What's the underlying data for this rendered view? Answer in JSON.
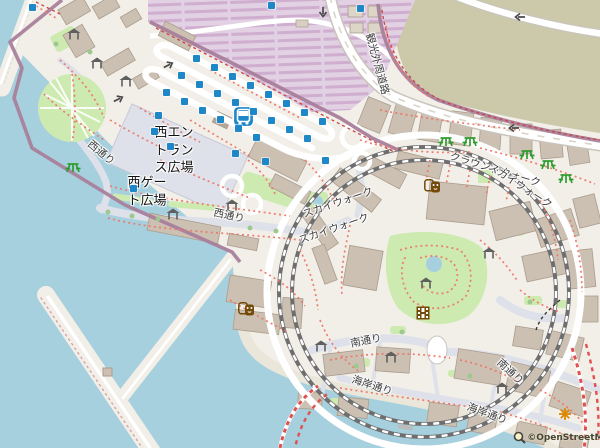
{
  "map": {
    "attribution": "©OpenStreetMap",
    "colors": {
      "water": "#a6d0dd",
      "land": "#f2efe9",
      "building": "#cbc0b2",
      "building_stroke": "#ab9d8d",
      "pedestrian": "#dee0ea",
      "grass": "#cdeab0",
      "heath": "#cbc9a9",
      "parking_stripe_dark": "#cfaed0",
      "parking_stripe_light": "#e2d0e3",
      "theme_park_boundary": "#a97f9b",
      "footpath": "#ee7768",
      "railway": "#6e6e6e",
      "bus_blue": "#1e87c8",
      "picnic_green": "#2e9b2e",
      "shelter_gray": "#5f5f5f",
      "amenity_brown": "#734a08",
      "attraction_orange": "#dd8800"
    },
    "labels": [
      {
        "id": "west-entrance-plaza",
        "text": "西エン\nトラン\nス広場",
        "x": 174,
        "y": 151,
        "rot": 0,
        "cls": "place"
      },
      {
        "id": "west-gate-plaza",
        "text": "西ゲー\nト広場",
        "x": 147,
        "y": 192,
        "rot": 0,
        "cls": "place"
      },
      {
        "id": "west-street-1",
        "text": "西通り",
        "x": 101,
        "y": 153,
        "rot": 40,
        "cls": "street"
      },
      {
        "id": "west-street-2",
        "text": "西通り",
        "x": 229,
        "y": 216,
        "rot": 12,
        "cls": "street"
      },
      {
        "id": "kanko-gaishu-road",
        "text": "観光外周道路",
        "x": 377,
        "y": 64,
        "rot": 75,
        "cls": "street"
      },
      {
        "id": "ground-walk",
        "text": "クラウンドウォーク",
        "x": 495,
        "y": 170,
        "rot": 17,
        "cls": "street"
      },
      {
        "id": "sky-walk-left-1",
        "text": "スカイウォーク",
        "x": 338,
        "y": 203,
        "rot": -19,
        "cls": "street"
      },
      {
        "id": "sky-walk-left-2",
        "text": "スカイウォーク",
        "x": 334,
        "y": 229,
        "rot": -19,
        "cls": "street"
      },
      {
        "id": "sky-walk-right",
        "text": "スカイウォーク",
        "x": 520,
        "y": 186,
        "rot": 33,
        "cls": "street"
      },
      {
        "id": "south-street-1",
        "text": "南通り",
        "x": 366,
        "y": 341,
        "rot": -11,
        "cls": "street"
      },
      {
        "id": "south-street-2",
        "text": "南通り",
        "x": 510,
        "y": 372,
        "rot": 43,
        "cls": "street"
      },
      {
        "id": "coast-street-1",
        "text": "海岸通り",
        "x": 372,
        "y": 386,
        "rot": 18,
        "cls": "street"
      },
      {
        "id": "coast-street-2",
        "text": "海岸通り",
        "x": 487,
        "y": 414,
        "rot": 20,
        "cls": "street"
      }
    ],
    "icons": [
      {
        "type": "bus-station",
        "x": 243,
        "y": 116
      },
      {
        "type": "picnic",
        "x": 73,
        "y": 166
      },
      {
        "type": "picnic",
        "x": 446,
        "y": 140
      },
      {
        "type": "picnic",
        "x": 470,
        "y": 140
      },
      {
        "type": "picnic",
        "x": 527,
        "y": 153
      },
      {
        "type": "picnic",
        "x": 548,
        "y": 163
      },
      {
        "type": "picnic",
        "x": 566,
        "y": 177
      },
      {
        "type": "shelter",
        "x": 75,
        "y": 32
      },
      {
        "type": "shelter",
        "x": 98,
        "y": 61
      },
      {
        "type": "shelter",
        "x": 127,
        "y": 79
      },
      {
        "type": "shelter",
        "x": 174,
        "y": 212
      },
      {
        "type": "shelter",
        "x": 233,
        "y": 203
      },
      {
        "type": "shelter",
        "x": 322,
        "y": 344
      },
      {
        "type": "shelter",
        "x": 392,
        "y": 355
      },
      {
        "type": "shelter",
        "x": 490,
        "y": 251
      },
      {
        "type": "shelter",
        "x": 427,
        "y": 281
      },
      {
        "type": "shelter",
        "x": 503,
        "y": 386
      },
      {
        "type": "masks",
        "x": 432,
        "y": 185
      },
      {
        "type": "masks",
        "x": 246,
        "y": 308
      },
      {
        "type": "cinema",
        "x": 424,
        "y": 312
      },
      {
        "type": "attraction",
        "x": 566,
        "y": 413
      }
    ],
    "bus_stops": [
      {
        "x": 29,
        "y": 4
      },
      {
        "x": 268,
        "y": 2
      },
      {
        "x": 357,
        "y": 5
      },
      {
        "x": 193,
        "y": 55
      },
      {
        "x": 211,
        "y": 64
      },
      {
        "x": 229,
        "y": 73
      },
      {
        "x": 247,
        "y": 82
      },
      {
        "x": 265,
        "y": 91
      },
      {
        "x": 283,
        "y": 100
      },
      {
        "x": 301,
        "y": 109
      },
      {
        "x": 319,
        "y": 118
      },
      {
        "x": 178,
        "y": 72
      },
      {
        "x": 196,
        "y": 81
      },
      {
        "x": 214,
        "y": 90
      },
      {
        "x": 232,
        "y": 99
      },
      {
        "x": 250,
        "y": 108
      },
      {
        "x": 268,
        "y": 117
      },
      {
        "x": 286,
        "y": 126
      },
      {
        "x": 304,
        "y": 135
      },
      {
        "x": 163,
        "y": 89
      },
      {
        "x": 181,
        "y": 98
      },
      {
        "x": 199,
        "y": 107
      },
      {
        "x": 217,
        "y": 116
      },
      {
        "x": 235,
        "y": 125
      },
      {
        "x": 253,
        "y": 134
      },
      {
        "x": 155,
        "y": 112
      },
      {
        "x": 151,
        "y": 128
      },
      {
        "x": 167,
        "y": 143
      },
      {
        "x": 232,
        "y": 150
      },
      {
        "x": 262,
        "y": 158
      },
      {
        "x": 322,
        "y": 157
      },
      {
        "x": 130,
        "y": 185
      }
    ],
    "arrows": [
      {
        "x": 168,
        "y": 60,
        "rot": -27
      },
      {
        "x": 118,
        "y": 94,
        "rot": -27
      },
      {
        "x": 323,
        "y": 8,
        "rot": 90
      },
      {
        "x": 513,
        "y": 124,
        "rot": 180
      },
      {
        "x": 519,
        "y": 13,
        "rot": 180
      }
    ],
    "boat": {
      "x": 404,
      "y": 427
    }
  }
}
